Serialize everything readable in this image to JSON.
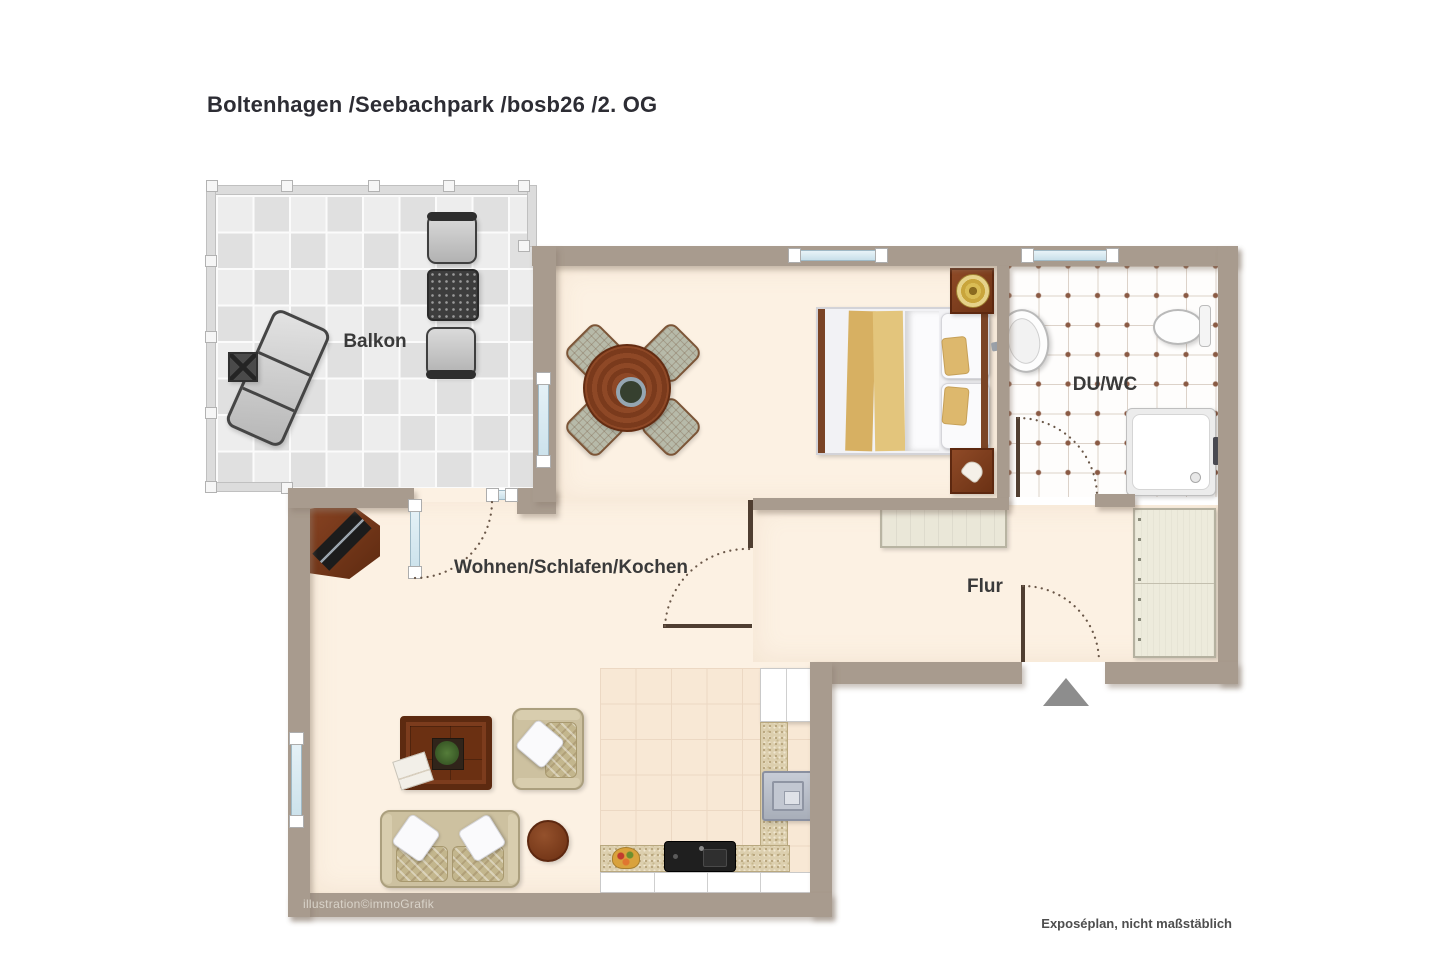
{
  "title": "Boltenhagen /Seebachpark /bosb26 /2. OG",
  "rooms": {
    "balcony": "Balkon",
    "living": "Wohnen/Schlafen/Kochen",
    "bath": "DU/WC",
    "hall": "Flur"
  },
  "credit": "illustration©immoGrafik",
  "disclaimer": "Exposéplan, nicht maßstäblich",
  "colors": {
    "wall": "#a89b8e",
    "walldark": "#4f3e31",
    "floor": "#fcf1e3",
    "tilea": "#ededed",
    "tileb": "#e0e0e0",
    "bathdot": "#8a5a44",
    "bathline": "#dcd2c9",
    "kittile": "#f8e8d5",
    "kitline": "#ecd8c3",
    "counter": "#dccfae",
    "sofa": "#cdc1a0",
    "arrow": "#8d8d8d",
    "titleink": "#2d2d34",
    "labelink": "#3a3a3a",
    "creditink": "#d9d3c9",
    "noteink": "#4e4e4e"
  }
}
